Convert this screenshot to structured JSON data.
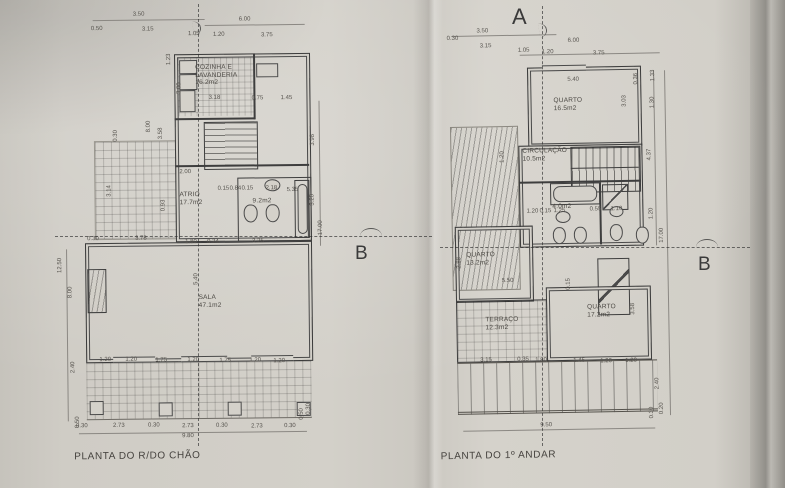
{
  "colors": {
    "paper": "#d2cfc8",
    "edge_shadow": "#a9a69f",
    "ink": "#3b3b3b",
    "dim_text": "#56534e"
  },
  "section_marks": {
    "a_label": "A",
    "b_label_left": "B",
    "b_label_right": "B"
  },
  "plans": {
    "ground": {
      "title": "PLANTA DO R/DO CHÃO",
      "rooms": [
        {
          "lines": [
            "COZINHA E",
            "LAVANDERIA",
            "16.2m2"
          ],
          "x": 197,
          "y": 62
        },
        {
          "lines": [
            "ATRIO",
            "17.7m2"
          ],
          "x": 180,
          "y": 189
        },
        {
          "lines": [
            "9.2m2"
          ],
          "x": 253,
          "y": 196
        },
        {
          "lines": [
            "SALA",
            "47.1m2"
          ],
          "x": 198,
          "y": 292
        }
      ],
      "dims": [
        {
          "t": "3.50",
          "x": 141,
          "y": 12
        },
        {
          "t": "0.50",
          "x": 99,
          "y": 26
        },
        {
          "t": "3.15",
          "x": 150,
          "y": 27
        },
        {
          "t": "6.00",
          "x": 247,
          "y": 18
        },
        {
          "t": "1.05",
          "x": 196,
          "y": 32
        },
        {
          "t": "1.20",
          "x": 221,
          "y": 33
        },
        {
          "t": "3.75",
          "x": 269,
          "y": 34
        },
        {
          "t": "1.23",
          "x": 171,
          "y": 57,
          "r": 1
        },
        {
          "t": "3.00",
          "x": 181,
          "y": 86,
          "r": 1
        },
        {
          "t": "3.18",
          "x": 216,
          "y": 96
        },
        {
          "t": "0.75",
          "x": 259,
          "y": 97
        },
        {
          "t": "1.45",
          "x": 288,
          "y": 97
        },
        {
          "t": "0.30",
          "x": 117,
          "y": 133,
          "r": 1
        },
        {
          "t": "3.14",
          "x": 110,
          "y": 188,
          "r": 1
        },
        {
          "t": "8.00",
          "x": 150,
          "y": 124,
          "r": 1
        },
        {
          "t": "3.58",
          "x": 162,
          "y": 131,
          "r": 1
        },
        {
          "t": "0.93",
          "x": 164,
          "y": 203,
          "r": 1
        },
        {
          "t": "2.00",
          "x": 186,
          "y": 170
        },
        {
          "t": "0.15",
          "x": 224,
          "y": 187
        },
        {
          "t": "0.84",
          "x": 236,
          "y": 187
        },
        {
          "t": "0.15",
          "x": 248,
          "y": 187
        },
        {
          "t": "2.18",
          "x": 272,
          "y": 187
        },
        {
          "t": "5.35",
          "x": 293,
          "y": 189
        },
        {
          "t": "1.80",
          "x": 191,
          "y": 240
        },
        {
          "t": "0.24",
          "x": 213,
          "y": 240
        },
        {
          "t": "3.25",
          "x": 258,
          "y": 240
        },
        {
          "t": "0.30",
          "x": 93,
          "y": 236
        },
        {
          "t": "3.78",
          "x": 141,
          "y": 236
        },
        {
          "t": "12.50",
          "x": 60,
          "y": 262,
          "r": 1
        },
        {
          "t": "8.00",
          "x": 70,
          "y": 289,
          "r": 1
        },
        {
          "t": "2.40",
          "x": 72,
          "y": 364,
          "r": 1
        },
        {
          "t": "0.50",
          "x": 76,
          "y": 419,
          "r": 1
        },
        {
          "t": "5.40",
          "x": 196,
          "y": 277,
          "r": 1
        },
        {
          "t": "3.98",
          "x": 314,
          "y": 139,
          "r": 1
        },
        {
          "t": "3.20",
          "x": 313,
          "y": 199,
          "r": 1
        },
        {
          "t": "17.00",
          "x": 321,
          "y": 227,
          "r": 1
        },
        {
          "t": "1.20",
          "x": 104,
          "y": 357
        },
        {
          "t": "1.20",
          "x": 130,
          "y": 357
        },
        {
          "t": "1.75",
          "x": 160,
          "y": 358
        },
        {
          "t": "1.20",
          "x": 192,
          "y": 358
        },
        {
          "t": "1.75",
          "x": 224,
          "y": 359
        },
        {
          "t": "1.20",
          "x": 254,
          "y": 359
        },
        {
          "t": "1.20",
          "x": 278,
          "y": 360
        },
        {
          "t": "0.30",
          "x": 80,
          "y": 423
        },
        {
          "t": "2.73",
          "x": 117,
          "y": 423
        },
        {
          "t": "0.30",
          "x": 152,
          "y": 423
        },
        {
          "t": "2.73",
          "x": 186,
          "y": 424
        },
        {
          "t": "0.30",
          "x": 220,
          "y": 424
        },
        {
          "t": "2.73",
          "x": 255,
          "y": 425
        },
        {
          "t": "0.30",
          "x": 288,
          "y": 425
        },
        {
          "t": "0.50",
          "x": 300,
          "y": 413,
          "r": 1
        },
        {
          "t": "0.30",
          "x": 307,
          "y": 408,
          "r": 1
        },
        {
          "t": "9.80",
          "x": 186,
          "y": 434
        }
      ]
    },
    "upper": {
      "title": "PLANTA DO 1º ANDAR",
      "rooms": [
        {
          "lines": [
            "QUARTO",
            "16.5m2"
          ],
          "x": 556,
          "y": 100
        },
        {
          "lines": [
            "CIRCULAÇÃO",
            "10.5m2"
          ],
          "x": 524,
          "y": 150
        },
        {
          "lines": [
            "4.0m2"
          ],
          "x": 553,
          "y": 206
        },
        {
          "lines": [
            "QUARTO",
            "13.2m2"
          ],
          "x": 466,
          "y": 253
        },
        {
          "lines": [
            "TERRAÇO",
            "12.3m2"
          ],
          "x": 484,
          "y": 318
        },
        {
          "lines": [
            "QUARTO",
            "17.2m2"
          ],
          "x": 586,
          "y": 307
        }
      ],
      "dims": [
        {
          "t": "3.50",
          "x": 486,
          "y": 33
        },
        {
          "t": "0.30",
          "x": 456,
          "y": 40
        },
        {
          "t": "3.15",
          "x": 489,
          "y": 48
        },
        {
          "t": "6.00",
          "x": 577,
          "y": 44
        },
        {
          "t": "1.05",
          "x": 527,
          "y": 53
        },
        {
          "t": "1.20",
          "x": 551,
          "y": 55
        },
        {
          "t": "3.75",
          "x": 602,
          "y": 57
        },
        {
          "t": "5.40",
          "x": 576,
          "y": 83
        },
        {
          "t": "0.36",
          "x": 639,
          "y": 83,
          "r": 1
        },
        {
          "t": "1.33",
          "x": 656,
          "y": 80,
          "r": 1
        },
        {
          "t": "3.03",
          "x": 627,
          "y": 105,
          "r": 1
        },
        {
          "t": "1.30",
          "x": 655,
          "y": 107,
          "r": 1
        },
        {
          "t": "4.37",
          "x": 651,
          "y": 159,
          "r": 1
        },
        {
          "t": "1.20",
          "x": 504,
          "y": 159,
          "r": 1
        },
        {
          "t": "1.20",
          "x": 652,
          "y": 218,
          "r": 1
        },
        {
          "t": "17.00",
          "x": 662,
          "y": 240,
          "r": 1
        },
        {
          "t": "1.20",
          "x": 533,
          "y": 214
        },
        {
          "t": "0.15",
          "x": 546,
          "y": 214
        },
        {
          "t": "1.25",
          "x": 560,
          "y": 214
        },
        {
          "t": "0.55",
          "x": 596,
          "y": 213
        },
        {
          "t": "1.10",
          "x": 617,
          "y": 213
        },
        {
          "t": "2.88",
          "x": 459,
          "y": 264,
          "r": 1
        },
        {
          "t": "5.50",
          "x": 507,
          "y": 283
        },
        {
          "t": "0.15",
          "x": 568,
          "y": 287,
          "r": 1
        },
        {
          "t": "3.58",
          "x": 632,
          "y": 313,
          "r": 1
        },
        {
          "t": "3.15",
          "x": 484,
          "y": 362
        },
        {
          "t": "0.35",
          "x": 521,
          "y": 362
        },
        {
          "t": "1.80",
          "x": 539,
          "y": 363
        },
        {
          "t": "1.45",
          "x": 577,
          "y": 364
        },
        {
          "t": "1.20",
          "x": 604,
          "y": 365
        },
        {
          "t": "1.20",
          "x": 629,
          "y": 365
        },
        {
          "t": "2.40",
          "x": 655,
          "y": 388,
          "r": 1
        },
        {
          "t": "0.30",
          "x": 649,
          "y": 417,
          "r": 1
        },
        {
          "t": "0.20",
          "x": 659,
          "y": 413,
          "r": 1
        },
        {
          "t": "9.50",
          "x": 543,
          "y": 428
        }
      ]
    }
  }
}
